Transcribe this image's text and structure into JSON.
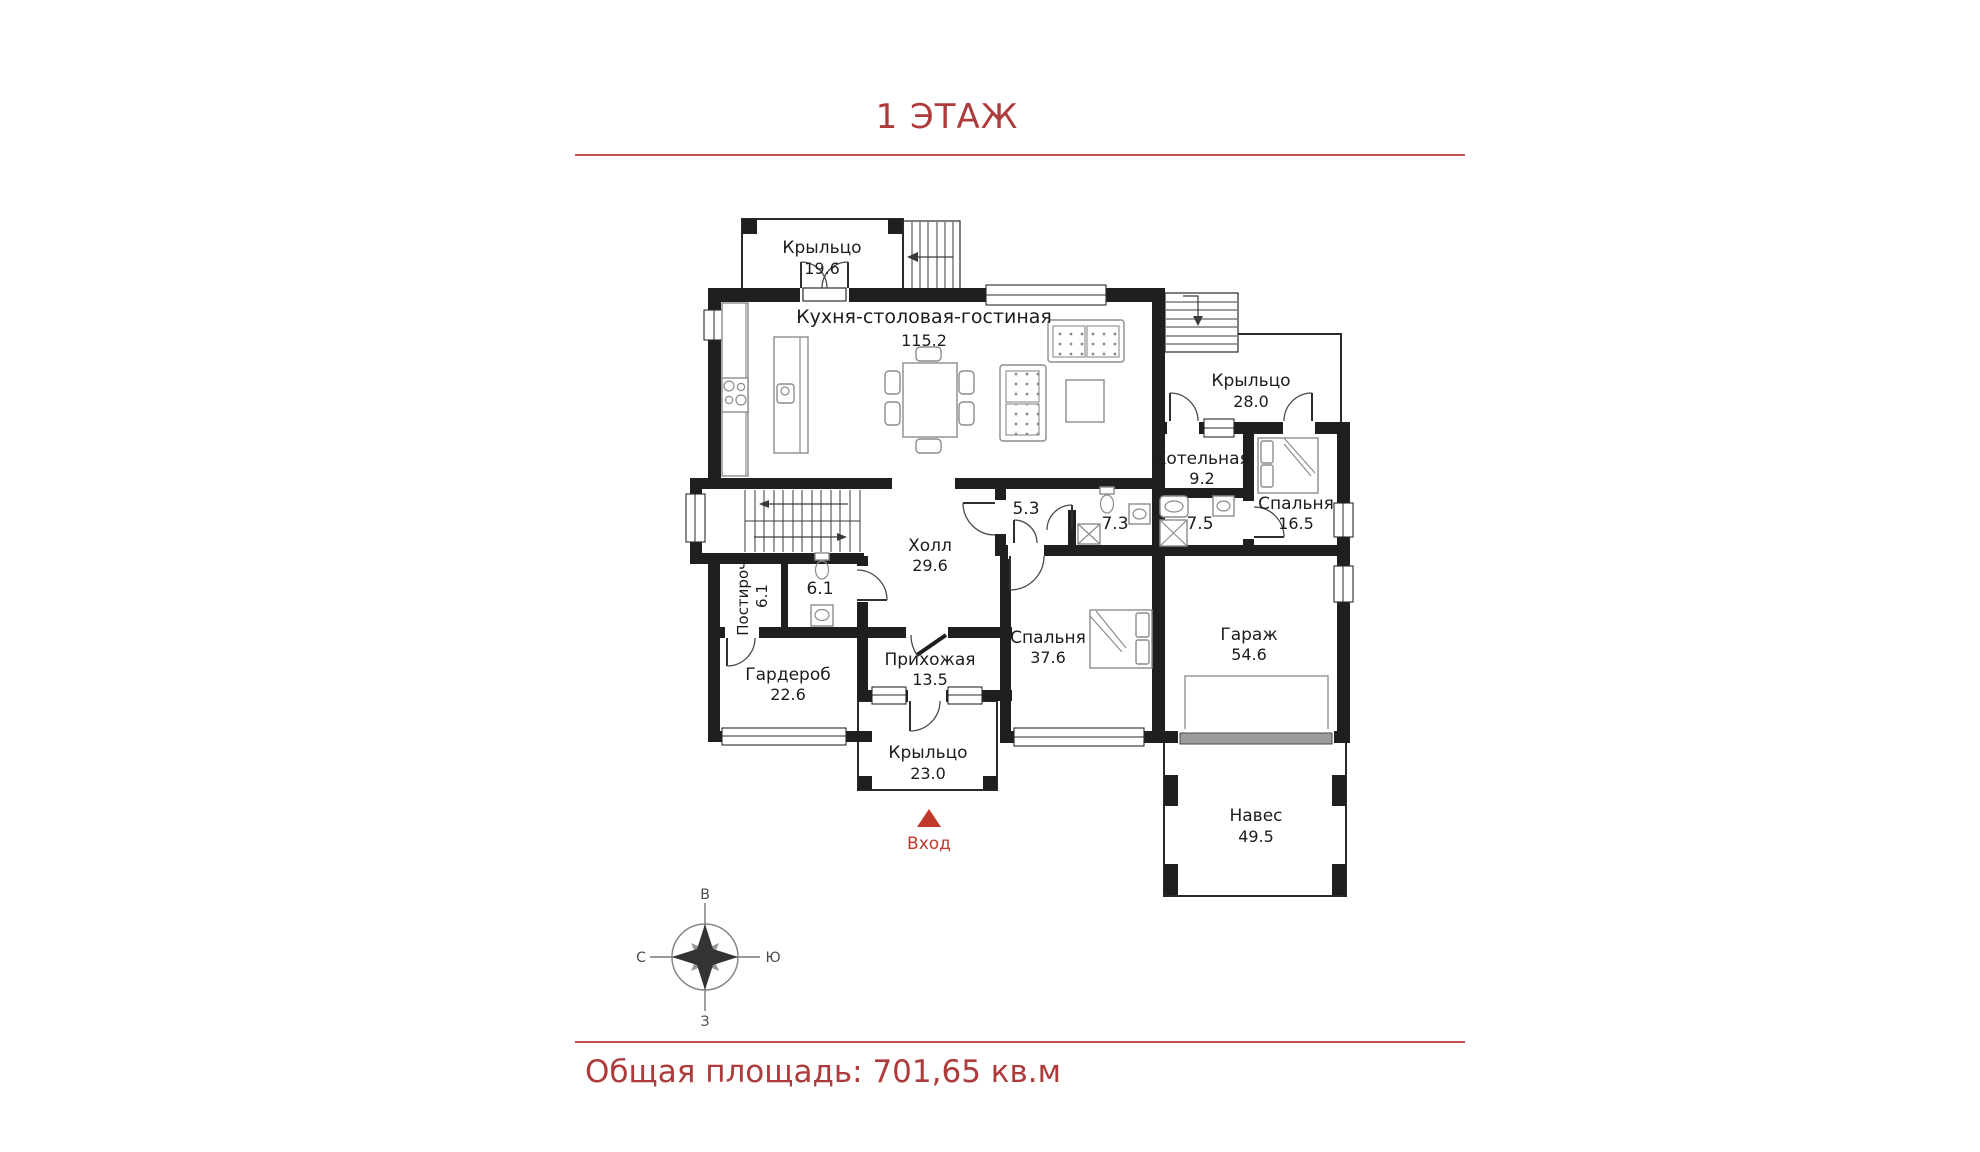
{
  "title": "1 ЭТАЖ",
  "footer": {
    "total_area": "Общая площадь: 701,65 кв.м"
  },
  "accent_color": "#ae3b3b",
  "entrance": {
    "label": "Вход",
    "marker_color": "#c0392b"
  },
  "compass": {
    "top": "В",
    "right": "Ю",
    "left": "С",
    "bottom": "З"
  },
  "rooms": [
    {
      "id": "porch-top",
      "name": "Крыльцо",
      "area": "19.6"
    },
    {
      "id": "kitchen",
      "name": "Кухня-столовая-гостиная",
      "area": "115.2"
    },
    {
      "id": "porch-right",
      "name": "Крыльцо",
      "area": "28.0"
    },
    {
      "id": "boiler",
      "name": "Котельная",
      "area": "9.2"
    },
    {
      "id": "bedroom-16",
      "name": "Спальня",
      "area": "16.5"
    },
    {
      "id": "wc-53",
      "name": "",
      "area": "5.3"
    },
    {
      "id": "bath-73",
      "name": "",
      "area": "7.3"
    },
    {
      "id": "bath-75",
      "name": "",
      "area": "7.5"
    },
    {
      "id": "hall",
      "name": "Холл",
      "area": "29.6"
    },
    {
      "id": "laundry",
      "name": "Постироч.",
      "area": "6.1"
    },
    {
      "id": "wc-61",
      "name": "",
      "area": "6.1"
    },
    {
      "id": "wardrobe",
      "name": "Гардероб",
      "area": "22.6"
    },
    {
      "id": "entry-hall",
      "name": "Прихожая",
      "area": "13.5"
    },
    {
      "id": "bedroom-37",
      "name": "Спальня",
      "area": "37.6"
    },
    {
      "id": "garage",
      "name": "Гараж",
      "area": "54.6"
    },
    {
      "id": "porch-bottom",
      "name": "Крыльцо",
      "area": "23.0"
    },
    {
      "id": "canopy",
      "name": "Навес",
      "area": "49.5"
    }
  ]
}
